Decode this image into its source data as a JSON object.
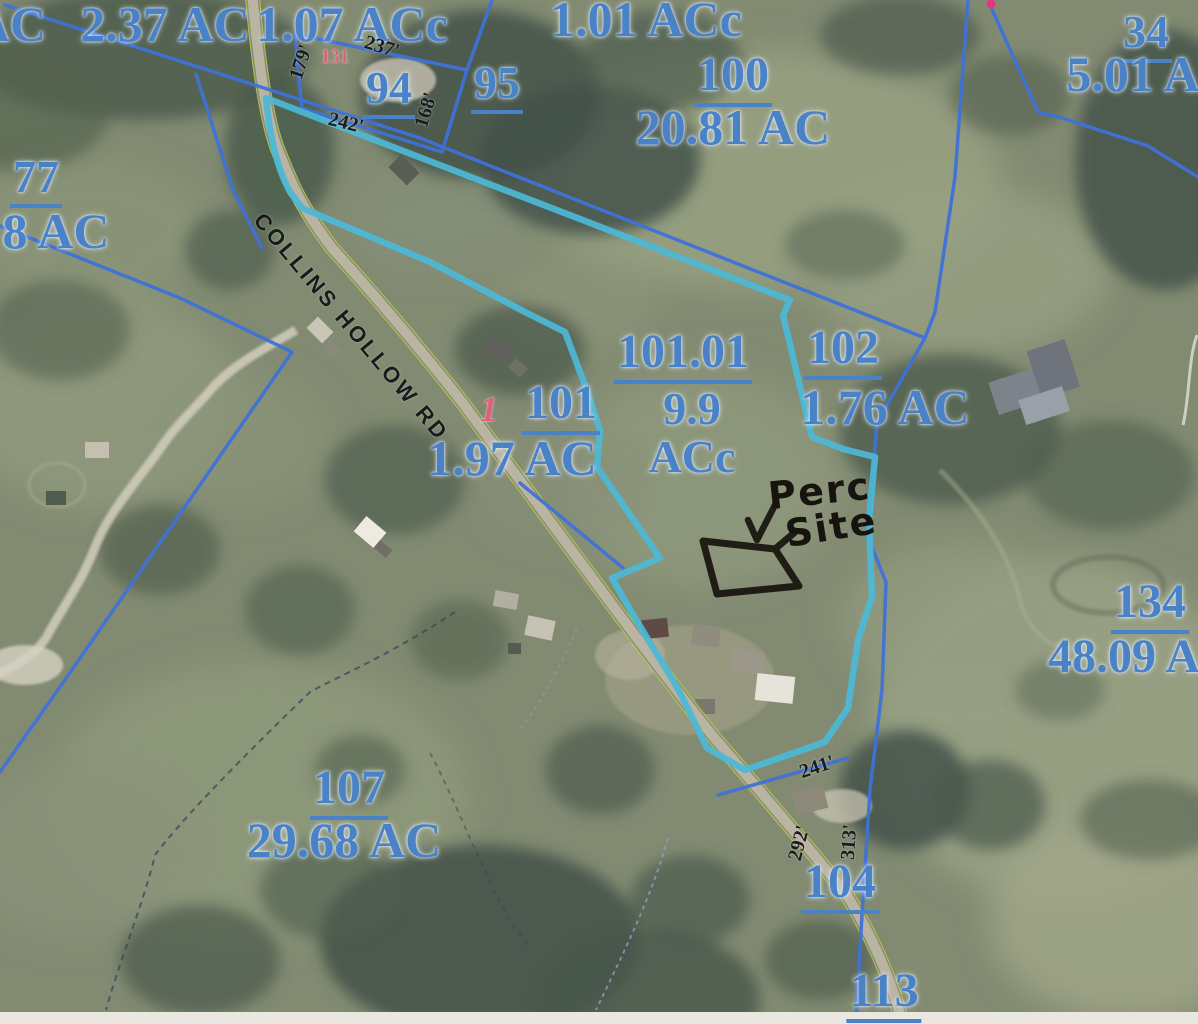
{
  "map_type": "county parcel / plat map over aerial photo",
  "road": {
    "name": "COLLINS HOLLOW RD"
  },
  "parcels": {
    "edge_topleft": {
      "acreage": "AC"
    },
    "top_237": {
      "acreage": "2.37 AC"
    },
    "top_107c": {
      "acreage": "1.07 ACc"
    },
    "top_101c": {
      "acreage": "1.01 ACc"
    },
    "p34": {
      "number": "34",
      "acreage": "5.01 A"
    },
    "p77": {
      "number": "77",
      "acreage": "8 AC"
    },
    "p94": {
      "number": "94"
    },
    "p95": {
      "number": "95"
    },
    "p100": {
      "number": "100",
      "acreage": "20.81 AC"
    },
    "p101": {
      "number": "101",
      "acreage": "1.97 AC"
    },
    "p101_01": {
      "number": "101.01",
      "acreage_line1": "9.9",
      "acreage_line2": "ACc"
    },
    "p102": {
      "number": "102",
      "acreage": "1.76 AC"
    },
    "p104": {
      "number": "104"
    },
    "p107": {
      "number": "107",
      "acreage": "29.68 AC"
    },
    "p113": {
      "number": "113"
    },
    "p134": {
      "number": "134",
      "acreage": "48.09 A"
    }
  },
  "measurements": {
    "m179": "179'",
    "m237": "237'",
    "m242": "242'",
    "m168": "168'",
    "m241": "241'",
    "m292": "292'",
    "m313": "313'"
  },
  "red_marks": {
    "lot131": "131",
    "lot1": "1"
  },
  "handwritten": {
    "line1": "Perc",
    "line2": "Site"
  },
  "colors": {
    "parcel_line": "#3f72d8",
    "highlight_boundary": "#4cb9d6",
    "parcel_label_text": "#4a82c8",
    "measurement_text": "#1c1c1e",
    "red_mark_text": "#e0607a",
    "road_edge": "#b5cf40",
    "handwritten_ink": "#17130e"
  }
}
